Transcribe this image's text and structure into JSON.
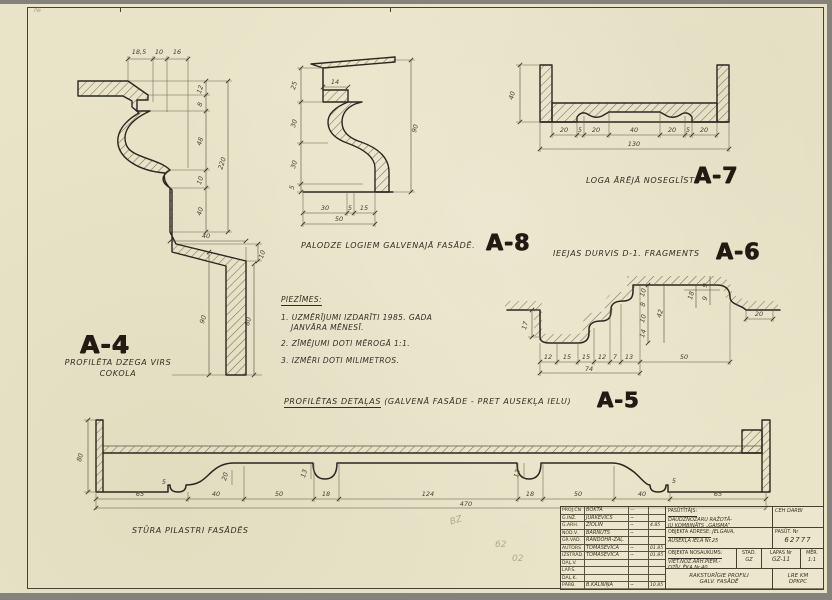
{
  "sheet": {
    "corner_mark": "№",
    "pencil_marks": [
      "BZ",
      "62",
      "02"
    ]
  },
  "a4": {
    "code": "A-4",
    "caption1": "PROFILĒTA DZEGA VIRS",
    "caption2": "COKOLA",
    "dims": {
      "top": [
        "18,5",
        "10",
        "16"
      ],
      "right": [
        "12",
        "8",
        "48",
        "10",
        "40"
      ],
      "total": "220",
      "flare_w": "40",
      "flare_h": "10",
      "h90": "90",
      "h80": "80"
    }
  },
  "a8": {
    "code": "A-8",
    "title": "PALODZE LOGIEM GALVENAJĀ FASĀDĒ.",
    "dims": {
      "left": [
        "25",
        "30",
        "30",
        "5"
      ],
      "height": "90",
      "step": "14",
      "bottom": [
        "30",
        "5",
        "15"
      ],
      "bottom_total": "50"
    }
  },
  "a7": {
    "code": "A-7",
    "title": "LOGA ĀRĒJĀ NOSEGLĪSTE",
    "dims": {
      "height": "40",
      "chain": [
        "20",
        "5",
        "20",
        "40",
        "20",
        "5",
        "20"
      ],
      "total": "130"
    }
  },
  "a6": {
    "code": "A-6",
    "title": "IEEJAS DURVIS D-1. FRAGMENTS",
    "dims": {
      "drop": "17",
      "chain": [
        "12",
        "15",
        "15",
        "12",
        "7",
        "13"
      ],
      "right_run": "50",
      "total": "74",
      "mid": [
        "10",
        "8",
        "10",
        "14"
      ],
      "mid_total": "42",
      "top_right": [
        "18",
        "9",
        "9"
      ],
      "flat_right": "20"
    }
  },
  "a5": {
    "code": "A-5",
    "title_main": "PROFILĒTAS DETAĻAS",
    "title_rest": "(GALVENĀ FASĀDE - PRET AUSEKĻA IELU)",
    "caption": "STŪRA PILASTRI FASĀDĒS",
    "dims": {
      "height": "80",
      "chain": [
        "65",
        "40",
        "50",
        "18",
        "124",
        "18",
        "50",
        "40",
        "65"
      ],
      "total": "470",
      "s5a": "5",
      "s20": "20",
      "s13a": "13",
      "s13b": "13",
      "s5b": "5"
    }
  },
  "notes": {
    "heading": "PIEZĪMES:",
    "l1": "1. UZMĒRĪJUMI IZDARĪTI 1985. GADA",
    "l2": "JANVĀRA MĒNESĪ.",
    "l3": "2. ZĪMĒJUMI DOTI MĒROGĀ 1:1.",
    "l4": "3. IZMĒRI DOTI MILIMETROS."
  },
  "tb": {
    "rows": [
      [
        "PROJ.ČN",
        "BOKTA",
        "—",
        ""
      ],
      [
        "G.INŽ.",
        "JURKEVIČS",
        "~",
        ""
      ],
      [
        "G.ARH.",
        "ZIOLIN",
        "~",
        "4.85"
      ],
      [
        "NOD.V.",
        "BARNUTS",
        "~",
        ""
      ],
      [
        "GR.VAD.",
        "RANDOHR-ZAĻ.",
        "",
        ""
      ],
      [
        "AUTORS",
        "TOMAŠĒVIČA",
        "~",
        "01.85"
      ],
      [
        "IZSTRĀD.",
        "TOMAŠĒVIČA",
        "~",
        "01.85"
      ],
      [
        "DAĻ.V.",
        "",
        "",
        ""
      ],
      [
        "LAP.S.",
        "",
        "",
        ""
      ],
      [
        "DAĻ.K.",
        "",
        "",
        ""
      ],
      [
        "PĀRB.",
        "B.KALNIŅA",
        "~",
        "10.85"
      ]
    ],
    "client_label": "PASŪTĪTĀJS:",
    "client_l1": "DAUDZNOZARU RAŽOTĀ-",
    "client_l2": "JU KOMBINĀTS „GAISMA”",
    "corner": "CEH DARBI",
    "addr_label": "OBJEKTA ADRESE:",
    "addr_l1": "JELGAVA,",
    "addr_l2": "AUSEKĻA IELA Nr.25",
    "order_label": "PASŪT. Nr",
    "order_value": "62777",
    "obj_label": "OBJEKTA NOSAUKUMS:",
    "obj_l1": "VIET.NOZ.ARH.PIEM.-",
    "obj_l2": "DZĪV. ĒKA Nr.40",
    "stage_label": "STAD.",
    "stage_value": "GZ",
    "sheet_label": "LAPAS Nr",
    "sheet_value": "GZ-11",
    "scale_label": "MĒR.",
    "scale_value": "1:1",
    "subj_l1": "RAKSTURĪGIE PROFILI",
    "subj_l2": "GALV. FASĀDĒ",
    "org_l1": "LRE KM",
    "org_l2": "DPKPC"
  }
}
